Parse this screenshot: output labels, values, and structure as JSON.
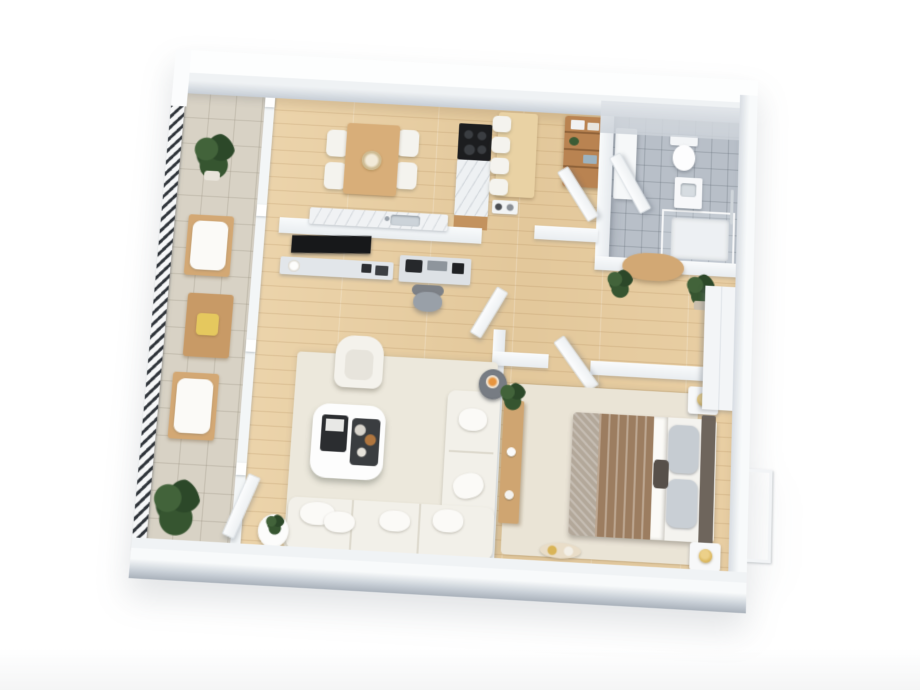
{
  "scene": {
    "title": "3D floor plan render — one-bedroom apartment",
    "view": "top-down isometric 3D render, plan rotated slightly clockwise on a white background",
    "rooms": [
      {
        "name": "balcony",
        "position": "left strip",
        "floor": "beige tile",
        "edge": "dark hatched railing",
        "items": [
          "potted plant (top)",
          "wooden armchair with white cushion",
          "wooden coffee table with yellow tray",
          "wooden armchair with white cushion",
          "potted plant (bottom)",
          "open glass door panel"
        ]
      },
      {
        "name": "kitchen-dining",
        "position": "top-left",
        "floor": "light oak planks",
        "items": [
          "wooden dining table with centerpiece plate",
          "4 cream dining chairs",
          "black cooktop",
          "marble island with wood base",
          "wooden bar counter",
          "4 white bar stools",
          "small appliances",
          "wooden shelf unit with boxes",
          "marble sink counter on half wall"
        ]
      },
      {
        "name": "living-room",
        "position": "center-left",
        "floor": "light oak planks",
        "items": [
          "cream area rug",
          "L-shaped white sofa with pillows",
          "white rounded coffee table with two dark trays",
          "white armchair",
          "dark round side table with lit candle",
          "wall-mounted black TV on half wall",
          "gray media console",
          "desk with equipment",
          "gray office chair",
          "small white plant table"
        ]
      },
      {
        "name": "hallway",
        "position": "center",
        "floor": "light oak planks",
        "items": [
          "round wooden console table",
          "two potted plants",
          "open white doors"
        ]
      },
      {
        "name": "bathroom",
        "position": "top-right",
        "floor": "gray tile",
        "items": [
          "white vanity unit",
          "open door",
          "toilet with tank",
          "sink cabinet",
          "walk-in shower with glass and tray",
          "chrome shower rail"
        ]
      },
      {
        "name": "bedroom",
        "position": "bottom-right",
        "floor": "light oak planks",
        "items": [
          "cream rug",
          "double bed with brown striped blanket",
          "dark headboard",
          "gray pillows",
          "2 white nightstands with gold lamps",
          "white wardrobe",
          "wooden console with plant and candles",
          "window with juliet railing",
          "two floor candle trays"
        ]
      }
    ],
    "palette": {
      "background": "#ffffff",
      "wall_white": "#f8fafb",
      "wall_shadow": "#c7ced6",
      "wood_floor": "#e6cda2",
      "balcony_tile": "#d8d2c5",
      "bathroom_tile": "#b8bfc8",
      "rug_cream": "#ece7db",
      "sofa_white": "#f2f0e9",
      "wood_furniture": "#d3a874",
      "shelf_brown": "#b98351",
      "bed_blanket_brown": "#9c7d60",
      "bed_pillow_gray": "#c6ccd2",
      "headboard_taupe": "#6e655c",
      "plant_green": "#31502f",
      "lamp_gold": "#d9b457",
      "tv_black": "#17181a",
      "railing_dark": "#2f343a",
      "candle_flame": "#e8953f"
    }
  }
}
